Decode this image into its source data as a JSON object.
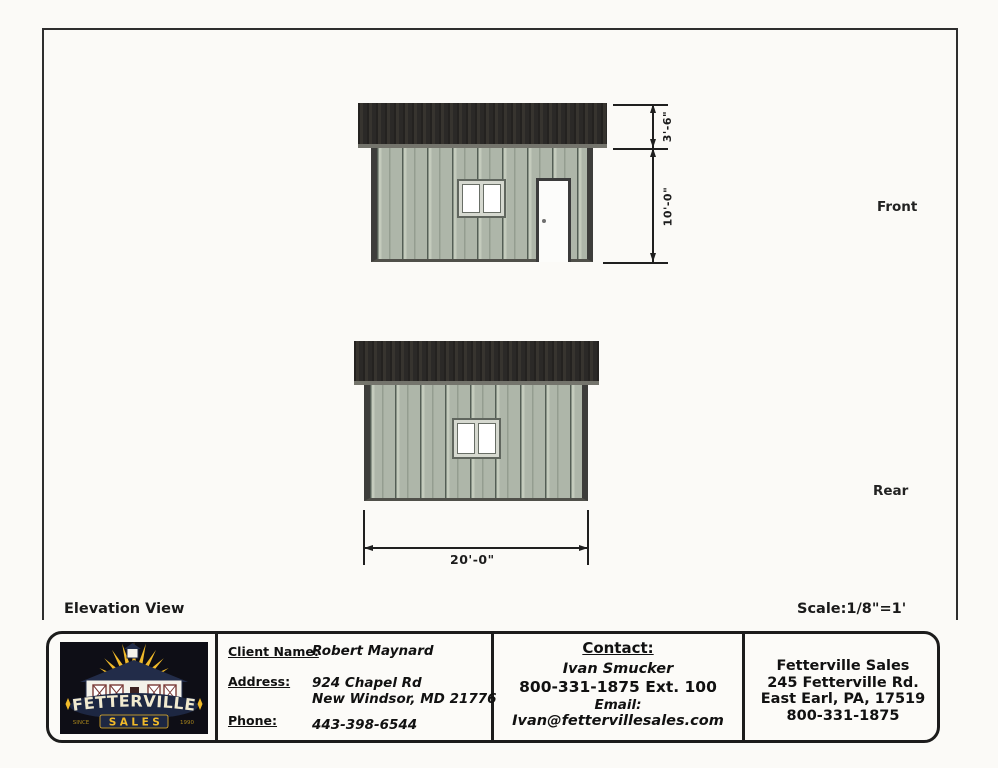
{
  "sheet": {
    "view_title": "Elevation View",
    "scale": "Scale:1/8\"=1'"
  },
  "front": {
    "label": "Front",
    "dim_roof": "3'-6\"",
    "dim_wall": "10'-0\""
  },
  "rear": {
    "label": "Rear",
    "dim_width": "20'-0\""
  },
  "colors": {
    "siding_green": "#aeb6a9",
    "roof_charcoal": "#2d2b29",
    "trim_dark": "#3d3d3b",
    "logo_navy": "#1d2742",
    "logo_yellow": "#f0b929"
  },
  "title_block": {
    "logo": {
      "brand": "FETTERVILLE",
      "sub": "SALES",
      "since": "SINCE",
      "year": "1990"
    },
    "client": {
      "name_label": "Client Name:",
      "name": "Robert Maynard",
      "address_label": "Address:",
      "address_line1": "924 Chapel Rd",
      "address_line2": "New Windsor, MD 21776",
      "phone_label": "Phone:",
      "phone": "443-398-6544"
    },
    "contact": {
      "heading": "Contact:",
      "name": "Ivan Smucker",
      "phone": "800-331-1875 Ext. 100",
      "email_label": "Email:",
      "email": "Ivan@fettervillesales.com"
    },
    "company": {
      "name": "Fetterville Sales",
      "address_line1": "245 Fetterville Rd.",
      "address_line2": "East Earl, PA, 17519",
      "phone": "800-331-1875"
    }
  }
}
